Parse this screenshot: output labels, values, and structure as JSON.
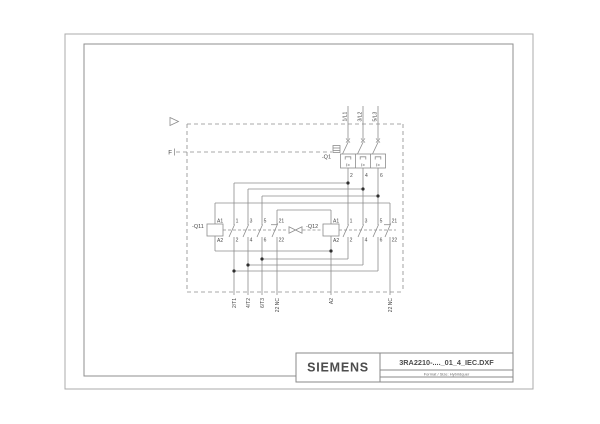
{
  "page": {
    "background": "#ffffff",
    "line_color": "#8c8c8c",
    "frame_color": "#a0a0a0",
    "text_color": "#4a4a4a"
  },
  "title_block": {
    "brand": "SIEMENS",
    "drawing_name": "3RA2210-...._01_4_IEC.DXF",
    "format_label": "Format / Size: Hybridquer"
  },
  "boundary_markers": {
    "function_line": "F"
  },
  "supply_labels": [
    "1/L1",
    "3/L2",
    "5/L3"
  ],
  "breaker": {
    "ref": "-Q1",
    "trip_symbol": "I>",
    "output_terminals": [
      "2",
      "4",
      "6"
    ]
  },
  "q11": {
    "ref": "-Q11",
    "coil_top": "A1",
    "coil_bottom": "A2",
    "contacts": [
      {
        "top": "1",
        "bottom": "2"
      },
      {
        "top": "3",
        "bottom": "4"
      },
      {
        "top": "5",
        "bottom": "6"
      },
      {
        "top": "21",
        "bottom": "22"
      }
    ]
  },
  "q12": {
    "ref": "-Q12",
    "coil_top": "A1",
    "coil_bottom": "A2",
    "contacts": [
      {
        "top": "1",
        "bottom": "2"
      },
      {
        "top": "3",
        "bottom": "4"
      },
      {
        "top": "5",
        "bottom": "6"
      },
      {
        "top": "21",
        "bottom": "22"
      }
    ]
  },
  "bottom_terminals": [
    "2/T1",
    "4/T2",
    "6/T3",
    "22 NC",
    "A2",
    "22 NC"
  ]
}
